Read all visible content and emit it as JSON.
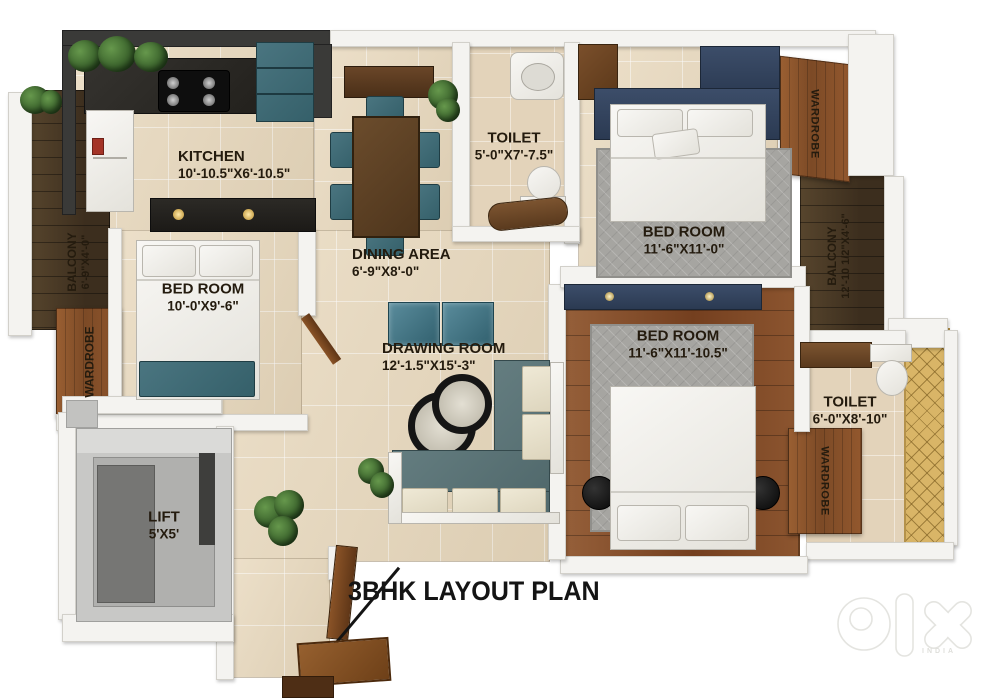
{
  "title": "3BHK LAYOUT PLAN",
  "watermark": {
    "brand": "olx",
    "country": "INDIA"
  },
  "rooms": {
    "kitchen": {
      "name": "KITCHEN",
      "dims": "10'-10.5\"X6'-10.5\""
    },
    "toilet_top": {
      "name": "TOILET",
      "dims": "5'-0\"X7'-7.5\""
    },
    "bedroom_top_right": {
      "name": "BED ROOM",
      "dims": "11'-6\"X11'-0\""
    },
    "balcony_left": {
      "name": "BALCONY",
      "dims": "6'-9\"X4'-0\""
    },
    "dining": {
      "name": "DINING AREA",
      "dims": "6'-9\"X8'-0\""
    },
    "bedroom_left": {
      "name": "BED ROOM",
      "dims": "10'-0'X9'-6\""
    },
    "balcony_right": {
      "name": "BALCONY",
      "dims": "12'-10 1/2\"X4'-6\""
    },
    "drawing_room": {
      "name": "DRAWING ROOM",
      "dims": "12'-1.5\"X15'-3\""
    },
    "bedroom_bottom_right": {
      "name": "BED ROOM",
      "dims": "11'-6\"X11'-10.5\""
    },
    "toilet_right": {
      "name": "TOILET",
      "dims": "6'-0\"X8'-10\""
    },
    "lift": {
      "name": "LIFT",
      "dims": "5'X5'"
    },
    "wardrobe_top_right": {
      "name": "WARDROBE"
    },
    "wardrobe_left": {
      "name": "WARDROBE"
    },
    "wardrobe_bottom_right": {
      "name": "WARDROBE"
    }
  },
  "colors": {
    "floor_beige": "#e8d8bc",
    "balcony_wood": "#4a3926",
    "bedroom_wood": "#8a5430",
    "teal_furniture": "#3f6a72",
    "navy_headboard": "#34435c",
    "rug_gray": "#a6a5a1",
    "mosaic_gold": "#d9b567",
    "label_ink": "#241b0e"
  }
}
